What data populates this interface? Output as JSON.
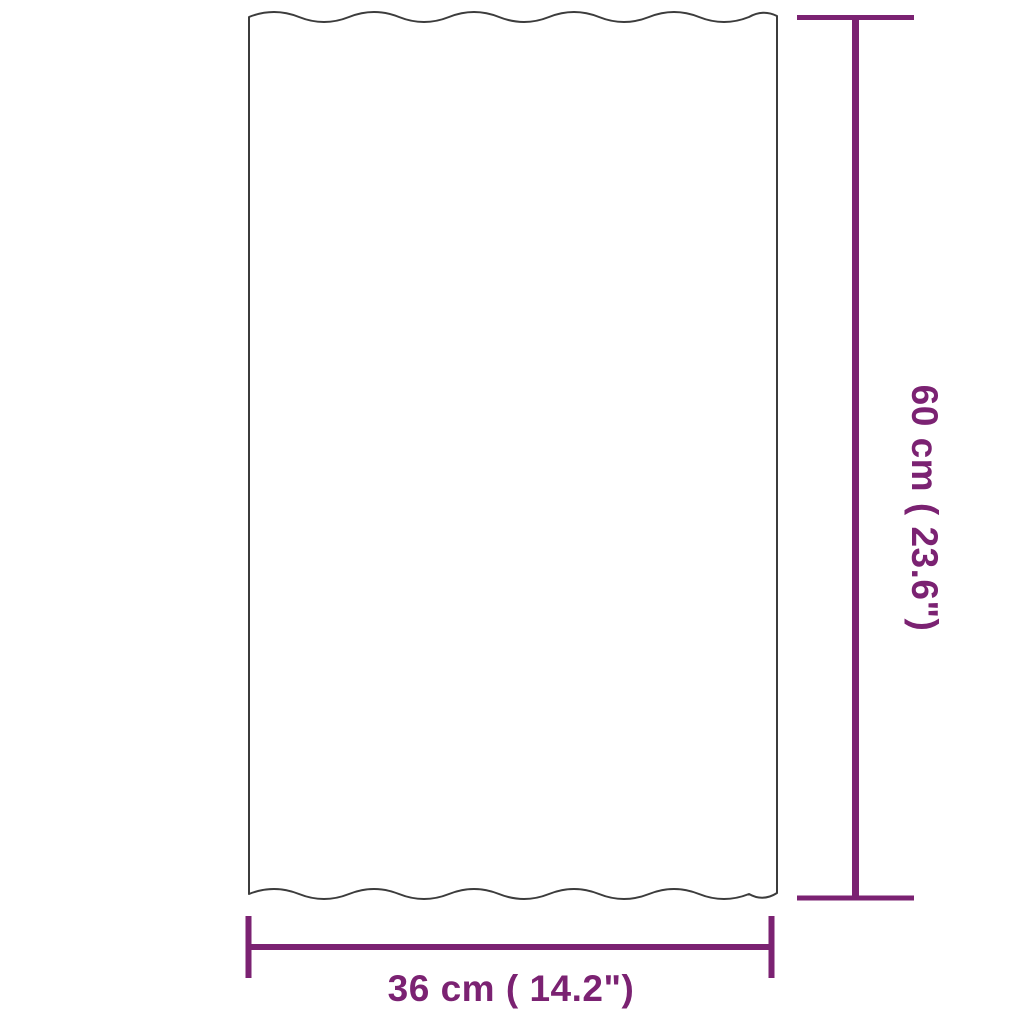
{
  "diagram": {
    "shape": "corrugated-panel-outline",
    "height_dimension": {
      "label": "60 cm ( 23.6\")",
      "value_cm": 60,
      "value_inch": 23.6
    },
    "width_dimension": {
      "label": "36 cm ( 14.2\")",
      "value_cm": 36,
      "value_inch": 14.2
    },
    "colors": {
      "dimension_accent": "#7B2272",
      "panel_outline": "#3C3C3C",
      "background": "#FFFFFF"
    }
  }
}
